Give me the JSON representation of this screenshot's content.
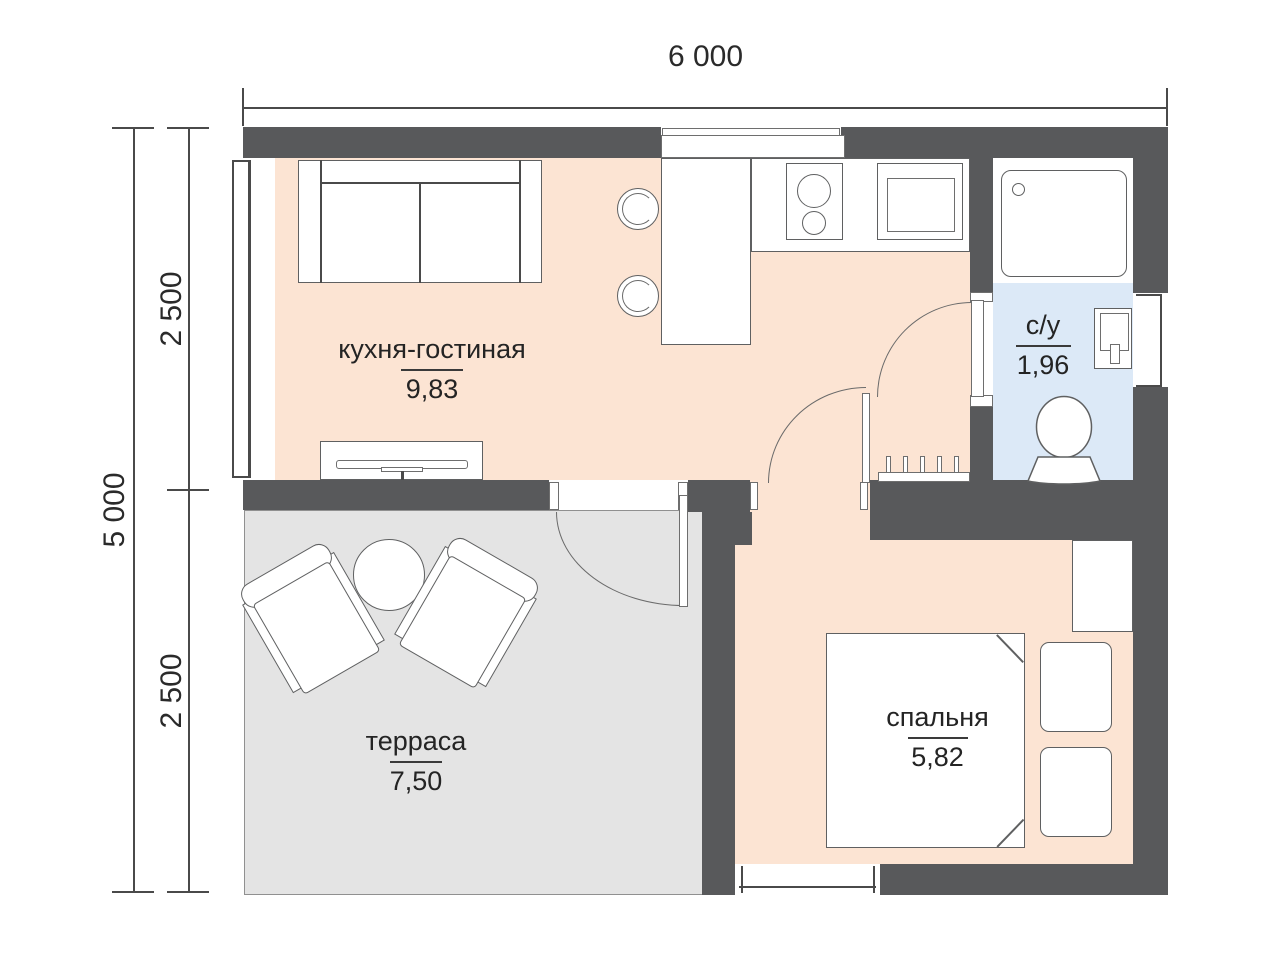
{
  "dimensions": {
    "width_total": "6 000",
    "height_total": "5 000",
    "height_top": "2 500",
    "height_bottom": "2 500"
  },
  "rooms": {
    "kitchen_living": {
      "name": "кухня-гостиная",
      "area": "9,83"
    },
    "bathroom": {
      "name": "с/у",
      "area": "1,96"
    },
    "terrace": {
      "name": "терраса",
      "area": "7,50"
    },
    "bedroom": {
      "name": "спальня",
      "area": "5,82"
    }
  },
  "colors": {
    "wall": "#58595b",
    "floor-warm": "#fce4d3",
    "floor-bath": "#dce9f7",
    "floor-terrace": "#e4e4e4",
    "line": "#4a4a4a",
    "furn": "#5f6061",
    "text": "#242424"
  }
}
